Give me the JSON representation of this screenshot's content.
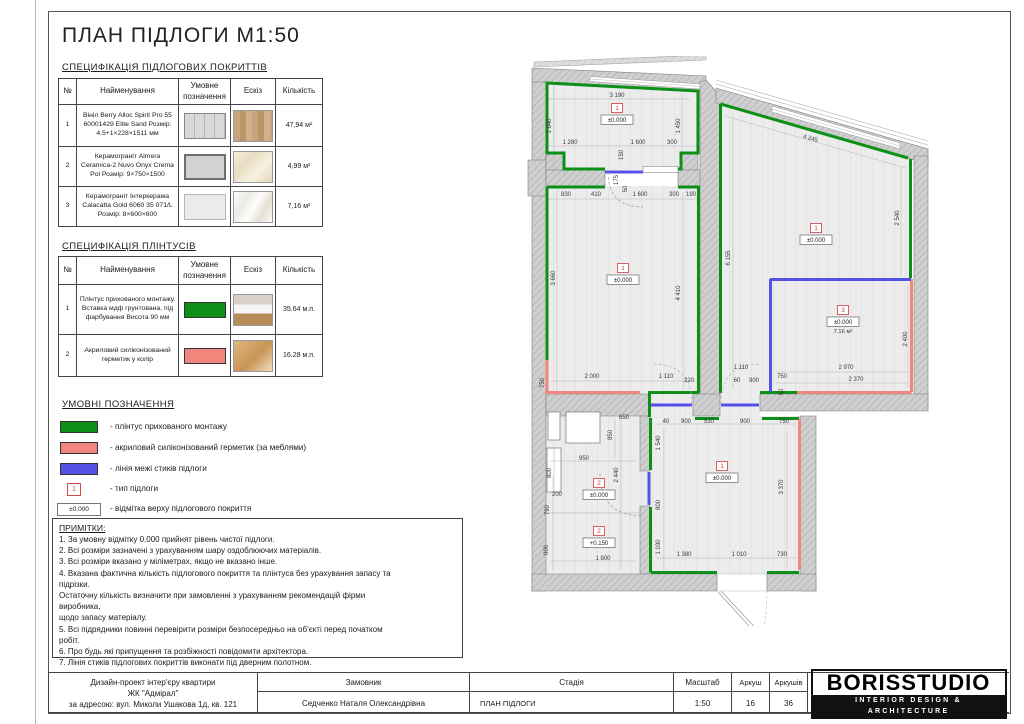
{
  "page": {
    "title": "ПЛАН ПІДЛОГИ М1:50"
  },
  "spec_floor": {
    "heading": "СПЕЦИФІКАЦІЯ ПІДЛОГОВИХ ПОКРИТТІВ",
    "columns": [
      "№",
      "Найменування",
      "Умовне позначення",
      "Ескіз",
      "Кількість"
    ],
    "rows": [
      {
        "num": "1",
        "name": "Вініл Berry Alloc Spirit Pro 55 60001429 Elite Sand Розмір: 4.5+1×228×1511 мм",
        "qty": "47,94 м²"
      },
      {
        "num": "2",
        "name": "Керамограніт Almera Ceramica-2 Nuvo Onyx Crema Pol Розмір: 9×750×1500",
        "qty": "4,99 м²"
      },
      {
        "num": "3",
        "name": "Керамограніт Інтеркерама Calacatta Gold 6060 35 071/L Розмір: 8×600×600",
        "qty": "7,16 м²"
      }
    ]
  },
  "spec_plinth": {
    "heading": "СПЕЦИФІКАЦІЯ ПЛІНТУСІВ",
    "columns": [
      "№",
      "Найменування",
      "Умовне позначення",
      "Ескіз",
      "Кількість"
    ],
    "rows": [
      {
        "num": "1",
        "name": "Плінтус прихованого монтажу. Вставка мдф грунтована, під фарбування Висота 90 мм",
        "qty": "35.64 м.п.",
        "color": "#0c9018"
      },
      {
        "num": "2",
        "name": "Акриловий силіконізований герметик у колір",
        "qty": "16.28 м.п.",
        "color": "#f2857c"
      }
    ]
  },
  "legend": {
    "heading": "УМОВНІ ПОЗНАЧЕННЯ",
    "items": [
      {
        "kind": "bar",
        "color": "#0c9018",
        "label": "- плінтус прихованого монтажу"
      },
      {
        "kind": "bar",
        "color": "#f2857c",
        "label": "- акриловий силіконізований герметик (за меблями)"
      },
      {
        "kind": "bar",
        "color": "#5551e6",
        "label": "- лінія межі стиків підлоги"
      },
      {
        "kind": "typebox",
        "symbol": "1",
        "label": "- тип підлоги"
      },
      {
        "kind": "elevbox",
        "symbol": "±0.000",
        "label": "- відмітка верху підлогового покриття"
      }
    ]
  },
  "notes": {
    "heading": "ПРИМІТКИ:",
    "lines": [
      "1. За умовну відмітку 0.000 прийнят рівень чистої підлоги.",
      "2. Всі розміри зазначені з урахуванням шару оздоблюючих матеріалів.",
      "3. Всі розміри вказано у міліметрах, якщо не вказано інше.",
      "4. Вказана фактична кількість підлогового покриття та плінтуса без урахування запасу та",
      "підрізки.",
      "Остаточну кількість визначити при замовленні з урахуванням рекомендацій фірми",
      "виробника,",
      "щодо запасу матеріалу.",
      "5. Всі підрядники повинні перевірити розміри безпосередньо на об'єкті перед початком",
      "робіт.",
      "6. Про будь які припущення та розбіжності повідомити архітектора.",
      "7. Лінія стиків підлогових покриттів виконати під дверним полотном."
    ]
  },
  "titleblock": {
    "project_line1": "Дизайн-проект інтер'єру квартири",
    "project_line2": "ЖК \"Адмірал\"",
    "project_line3": "за адресою: вул. Миколи Ушакова 1д, кв. 121",
    "client_label": "Замовник",
    "client": "Седченко Наталя Олександрівна",
    "stage_label": "Стадія",
    "stage": "ПЛАН ПІДЛОГИ",
    "scale_label": "Масштаб",
    "scale": "1:50",
    "sheet_label": "Аркуш",
    "sheet": "16",
    "sheets_label": "Аркушів",
    "sheets": "36",
    "logo": "BORISSTUDIO",
    "logo_sub": "INTERIOR DESIGN & ARCHITECTURE"
  },
  "plan": {
    "colors": {
      "plinth_green": "#0c9018",
      "sealant_pink": "#f2857c",
      "joint_blue": "#5551e6",
      "marker_red": "#d23b3b"
    },
    "dims": [
      {
        "x": 97,
        "y": 41,
        "t": "3 190"
      },
      {
        "x": 31,
        "y": 70,
        "t": "1 640",
        "r": "v"
      },
      {
        "x": 160,
        "y": 70,
        "t": "1 450",
        "r": "v"
      },
      {
        "x": 50,
        "y": 88,
        "t": "1 280"
      },
      {
        "x": 118,
        "y": 88,
        "t": "1 600"
      },
      {
        "x": 152,
        "y": 88,
        "t": "300"
      },
      {
        "x": 103,
        "y": 99,
        "t": "150",
        "r": "v"
      },
      {
        "x": 98,
        "y": 124,
        "t": "175",
        "r": "v"
      },
      {
        "x": 107,
        "y": 133,
        "t": "50",
        "r": "v"
      },
      {
        "x": 46,
        "y": 140,
        "t": "830"
      },
      {
        "x": 76,
        "y": 140,
        "t": "410"
      },
      {
        "x": 120,
        "y": 140,
        "t": "1 600"
      },
      {
        "x": 154,
        "y": 140,
        "t": "300"
      },
      {
        "x": 171,
        "y": 140,
        "t": "190"
      },
      {
        "x": 35,
        "y": 222,
        "t": "3 660",
        "r": "v"
      },
      {
        "x": 160,
        "y": 237,
        "t": "4 410",
        "r": "v"
      },
      {
        "x": 24,
        "y": 327,
        "t": "750",
        "r": "v"
      },
      {
        "x": 72,
        "y": 322,
        "t": "2 000"
      },
      {
        "x": 146,
        "y": 322,
        "t": "1 110"
      },
      {
        "x": 169,
        "y": 326,
        "t": "220"
      },
      {
        "x": 290,
        "y": 84,
        "t": "4 245",
        "r": 16
      },
      {
        "x": 210,
        "y": 202,
        "t": "6 155",
        "r": "v"
      },
      {
        "x": 379,
        "y": 162,
        "t": "2 540",
        "r": "v"
      },
      {
        "x": 387,
        "y": 283,
        "t": "2 400",
        "r": "v"
      },
      {
        "x": 221,
        "y": 313,
        "t": "1 110"
      },
      {
        "x": 217,
        "y": 326,
        "t": "60"
      },
      {
        "x": 234,
        "y": 326,
        "t": "900"
      },
      {
        "x": 262,
        "y": 322,
        "t": "750"
      },
      {
        "x": 326,
        "y": 313,
        "t": "2 970"
      },
      {
        "x": 336,
        "y": 325,
        "t": "2 370"
      },
      {
        "x": 263,
        "y": 336,
        "t": "50",
        "r": "v"
      },
      {
        "x": 146,
        "y": 367,
        "t": "40"
      },
      {
        "x": 166,
        "y": 367,
        "t": "900"
      },
      {
        "x": 189,
        "y": 367,
        "t": "530"
      },
      {
        "x": 225,
        "y": 367,
        "t": "900"
      },
      {
        "x": 264,
        "y": 367,
        "t": "750"
      },
      {
        "x": 140,
        "y": 387,
        "t": "1 540",
        "r": "v"
      },
      {
        "x": 140,
        "y": 449,
        "t": "800",
        "r": "v"
      },
      {
        "x": 140,
        "y": 491,
        "t": "1 030",
        "r": "v"
      },
      {
        "x": 263,
        "y": 431,
        "t": "3 370",
        "r": "v"
      },
      {
        "x": 164,
        "y": 500,
        "t": "1 380"
      },
      {
        "x": 219,
        "y": 500,
        "t": "1 010"
      },
      {
        "x": 262,
        "y": 500,
        "t": "730"
      },
      {
        "x": 104,
        "y": 363,
        "t": "650"
      },
      {
        "x": 92,
        "y": 379,
        "t": "850",
        "r": "v"
      },
      {
        "x": 64,
        "y": 404,
        "t": "950"
      },
      {
        "x": 31,
        "y": 417,
        "t": "800",
        "r": "v"
      },
      {
        "x": 98,
        "y": 419,
        "t": "2 440",
        "r": "v"
      },
      {
        "x": 37,
        "y": 440,
        "t": "200"
      },
      {
        "x": 29,
        "y": 454,
        "t": "790",
        "r": "v"
      },
      {
        "x": 28,
        "y": 494,
        "t": "900",
        "r": "v"
      },
      {
        "x": 83,
        "y": 504,
        "t": "1 800"
      }
    ],
    "markers": [
      {
        "x": 97,
        "y": 54,
        "num": "1",
        "elev": "±0.000"
      },
      {
        "x": 103,
        "y": 214,
        "num": "1",
        "elev": "±0.000"
      },
      {
        "x": 296,
        "y": 174,
        "num": "1",
        "elev": "±0.000"
      },
      {
        "x": 323,
        "y": 256,
        "num": "3",
        "elev": "±0.000",
        "area": "7.16 м²"
      },
      {
        "x": 202,
        "y": 412,
        "num": "1",
        "elev": "±0.000"
      },
      {
        "x": 79,
        "y": 429,
        "num": "2",
        "elev": "±0.000"
      },
      {
        "x": 79,
        "y": 477,
        "num": "2",
        "elev": "+0.150"
      }
    ]
  }
}
